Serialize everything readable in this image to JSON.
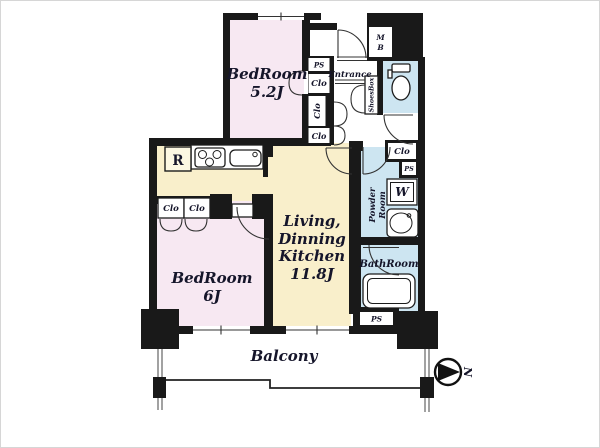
{
  "colors": {
    "bedroom_fill": "#f7e8f2",
    "ldk_fill": "#f9efcb",
    "wet_area_fill": "#cde5f1",
    "wall": "#191919",
    "background": "#ffffff"
  },
  "rooms": {
    "bedroom_upper": {
      "name": "BedRoom",
      "size": "5.2J"
    },
    "bedroom_lower": {
      "name": "BedRoom",
      "size": "6J"
    },
    "ldk": {
      "line1": "Living,",
      "line2": "Dinning",
      "line3": "Kitchen",
      "size": "11.8J"
    },
    "bathroom": {
      "name": "BathRoom"
    },
    "powder_room": {
      "line1": "Powder",
      "line2": "Room"
    },
    "entrance": {
      "name": "Entrance"
    },
    "balcony": {
      "name": "Balcony"
    }
  },
  "labels": {
    "closet": "Clo",
    "pipe_space": "PS",
    "meter_box_m": "M",
    "meter_box_b": "B",
    "washing_machine": "W",
    "refrigerator": "R",
    "shoes_box": "ShoesBox",
    "north": "N"
  }
}
